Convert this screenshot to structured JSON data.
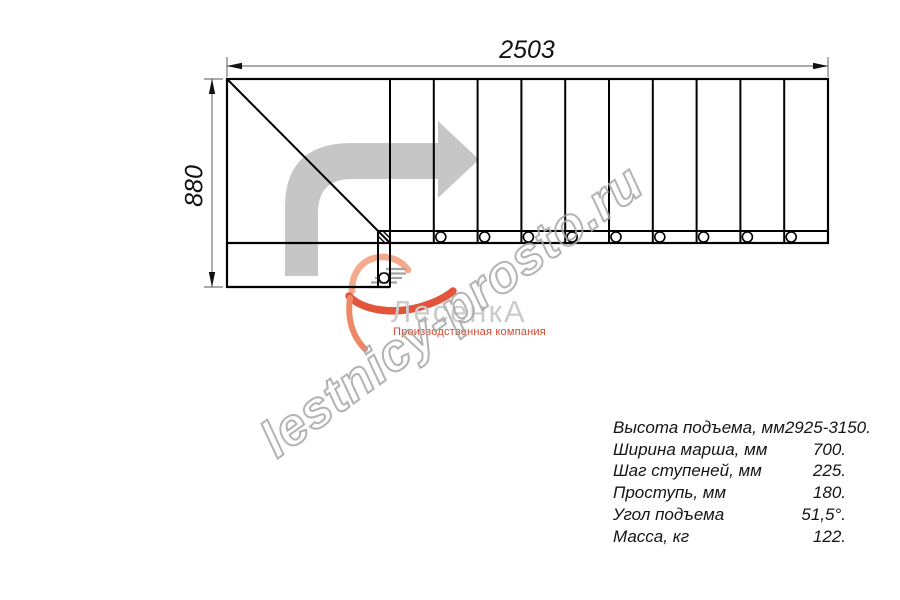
{
  "drawing": {
    "dimension_width": "2503",
    "dimension_height": "880",
    "tread_lines_count": 10,
    "bolt_holes_count": 10
  },
  "specs": {
    "rows": [
      {
        "label": "Высота подъема, мм",
        "value": "2925-3150."
      },
      {
        "label": "Ширина марша, мм",
        "value": "700."
      },
      {
        "label": "Шаг ступеней, мм",
        "value": "225."
      },
      {
        "label": "Проступь, мм",
        "value": "180."
      },
      {
        "label": "Угол подъема",
        "value": "51,5°."
      },
      {
        "label": "Масса, кг",
        "value": "122."
      }
    ]
  },
  "logo": {
    "name": "ЛесенкА",
    "tagline": "Производственная компания",
    "name_color": "#cbcbcb",
    "accent_color": "#e2553b"
  },
  "watermark": {
    "text": "lestnicy-prosto.ru",
    "color": "#a6a6a6"
  },
  "colors": {
    "plan_line": "#000000",
    "dimension_line": "#777777",
    "direction_arrow": "#c6c6c6"
  }
}
